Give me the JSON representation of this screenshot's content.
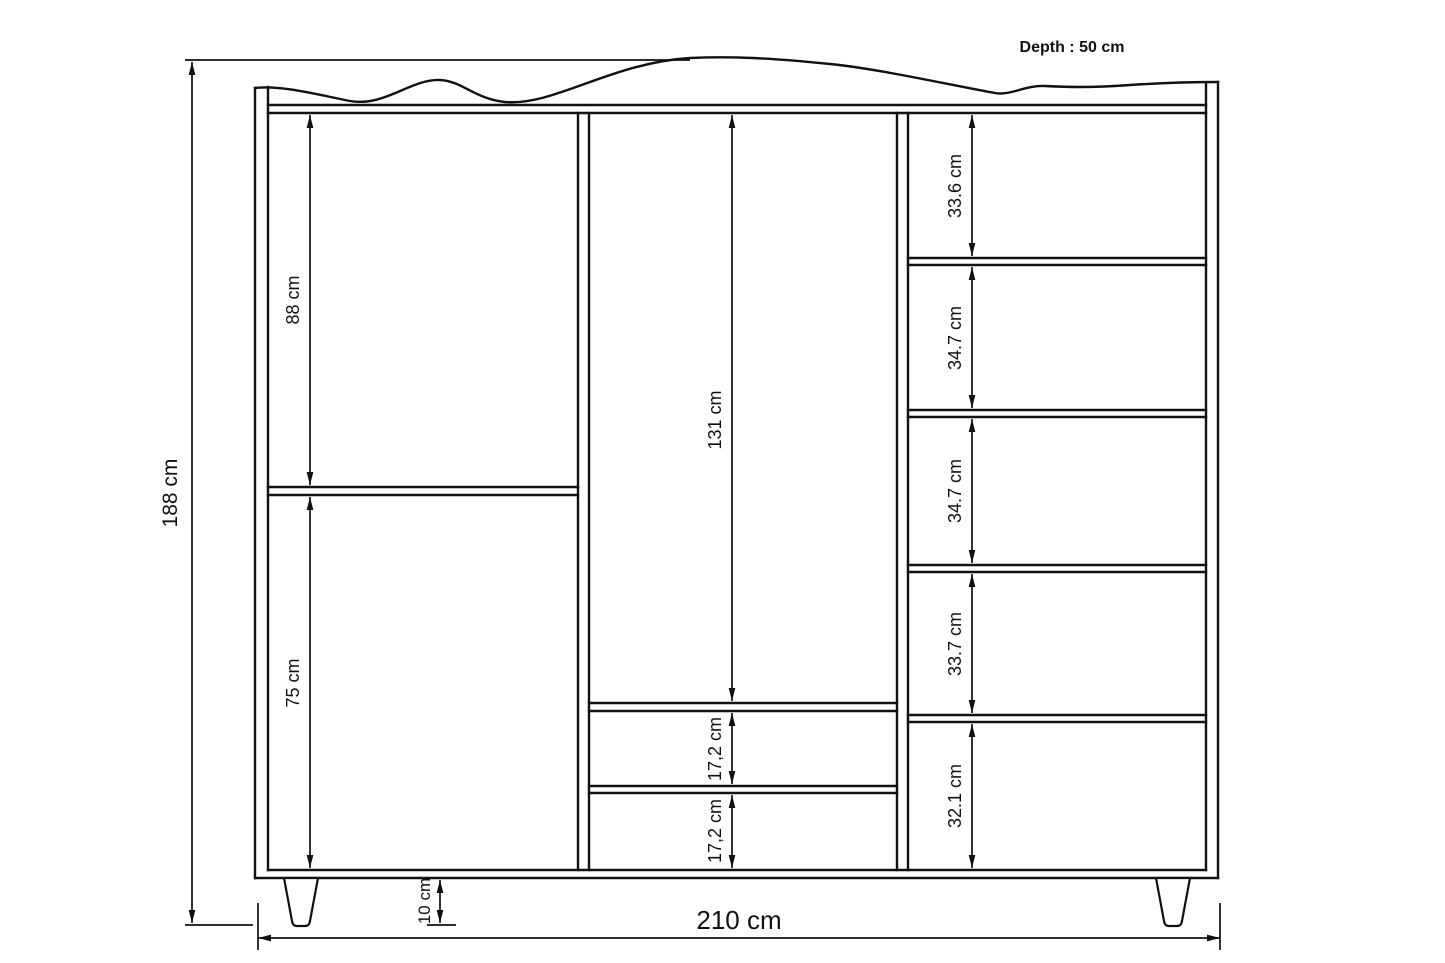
{
  "labels": {
    "depth": "Depth : 50 cm"
  },
  "dimensions": {
    "overall_height": "188 cm",
    "overall_width": "210 cm",
    "left_upper_section": "88 cm",
    "left_lower_section": "75 cm",
    "middle_hanging_section": "131 cm",
    "drawer_1": "17,2 cm",
    "drawer_2": "17,2 cm",
    "right_shelf_1": "33.6 cm",
    "right_shelf_2": "34.7 cm",
    "right_shelf_3": "34.7 cm",
    "right_shelf_4": "33.7 cm",
    "right_shelf_5": "32.1 cm",
    "foot_height": "10 cm"
  },
  "colors": {
    "line": "#111111",
    "background": "#ffffff"
  }
}
